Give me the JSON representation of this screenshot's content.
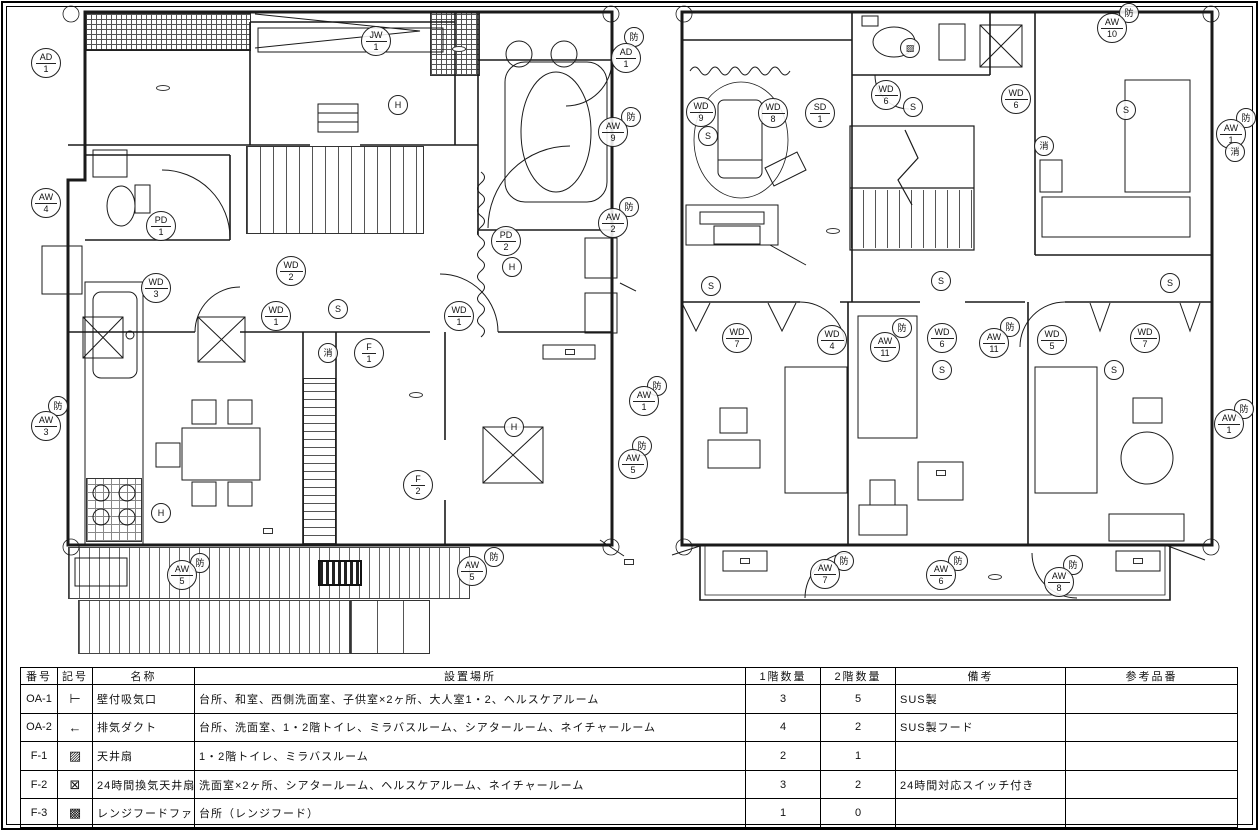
{
  "floor1": {
    "labels": [
      {
        "t": "玄関",
        "x": 103,
        "y": 47,
        "k": "r"
      },
      {
        "t": "ネイチャールーム",
        "x": 342,
        "y": 90,
        "k": "r"
      },
      {
        "t": "ギャラリー（廊下）",
        "x": 546,
        "y": 33,
        "k": "r"
      },
      {
        "t": "階段",
        "x": 325,
        "y": 165,
        "k": "r"
      },
      {
        "t": "トイレ",
        "x": 131,
        "y": 198,
        "k": "r"
      },
      {
        "t": "ミラバスルーム",
        "x": 558,
        "y": 220,
        "k": "r"
      },
      {
        "t": "廊下",
        "x": 386,
        "y": 307,
        "k": "r"
      },
      {
        "t": "台所",
        "x": 154,
        "y": 413,
        "k": "r"
      },
      {
        "t": "和室",
        "x": 520,
        "y": 399,
        "k": "r"
      },
      {
        "t": "ウッドデッキ",
        "x": 216,
        "y": 600,
        "k": "r"
      },
      {
        "t": "階段",
        "x": 378,
        "y": 631,
        "k": "r"
      },
      {
        "t": "収納",
        "x": 98,
        "y": 287,
        "k": "n"
      },
      {
        "t": "給湯器",
        "x": 44,
        "y": 297,
        "k": "n"
      },
      {
        "t": "室外機",
        "x": 52,
        "y": 240,
        "k": "n"
      },
      {
        "t": "2階用",
        "x": 62,
        "y": 257,
        "k": "n"
      },
      {
        "t": "防水",
        "x": 516,
        "y": 281,
        "k": "n"
      },
      {
        "t": "差動式",
        "x": 191,
        "y": 518,
        "k": "n"
      },
      {
        "t": "給湯器（大）",
        "x": 634,
        "y": 150,
        "k": "n"
      },
      {
        "t": "ファイアダンパー",
        "x": 650,
        "y": 180,
        "k": "n"
      },
      {
        "t": "室外機",
        "x": 646,
        "y": 294,
        "k": "n"
      },
      {
        "t": "2階用",
        "x": 602,
        "y": 260,
        "k": "n"
      },
      {
        "t": "和室用",
        "x": 602,
        "y": 315,
        "k": "n"
      },
      {
        "t": "濡れ縁",
        "x": 433,
        "y": 584,
        "k": "n"
      },
      {
        "t": "室外機",
        "x": 100,
        "y": 552,
        "k": "n"
      },
      {
        "t": "台所用",
        "x": 101,
        "y": 573,
        "k": "n"
      },
      {
        "t": "室内機",
        "x": 268,
        "y": 531,
        "k": "bx"
      },
      {
        "t": "室内機",
        "x": 570,
        "y": 352,
        "k": "bx"
      },
      {
        "t": "室内機",
        "x": 629,
        "y": 562,
        "k": "bx"
      },
      {
        "t": "1FL±0",
        "x": 163,
        "y": 88,
        "k": "lv"
      },
      {
        "t": "1FL±0",
        "x": 416,
        "y": 395,
        "k": "lv"
      },
      {
        "t": "1FL±0",
        "x": 459,
        "y": 49,
        "k": "lv"
      },
      {
        "t": "IN ▶",
        "x": 56,
        "y": 39,
        "k": "in"
      },
      {
        "t": "◀ IN",
        "x": 650,
        "y": 43,
        "k": "in"
      },
      {
        "t": "←",
        "x": 36,
        "y": 153,
        "k": "ar"
      },
      {
        "t": "←",
        "x": 57,
        "y": 265,
        "k": "ar"
      },
      {
        "t": "←",
        "x": 32,
        "y": 510,
        "k": "ar"
      },
      {
        "t": "→",
        "x": 625,
        "y": 161,
        "k": "ar"
      },
      {
        "t": "→",
        "x": 620,
        "y": 63,
        "k": "ar"
      },
      {
        "t": "⊠",
        "x": 120,
        "y": 266,
        "k": "fan"
      },
      {
        "t": "⊠",
        "x": 337,
        "y": 74,
        "k": "fan"
      },
      {
        "t": "⊠",
        "x": 544,
        "y": 266,
        "k": "fan"
      }
    ],
    "markers": [
      {
        "a": "AD",
        "b": "1",
        "x": 46,
        "y": 63
      },
      {
        "a": "JW",
        "b": "1",
        "x": 376,
        "y": 41
      },
      {
        "a": "H",
        "x": 398,
        "y": 105
      },
      {
        "a": "AW",
        "b": "4",
        "x": 46,
        "y": 203
      },
      {
        "a": "PD",
        "b": "1",
        "x": 161,
        "y": 226
      },
      {
        "a": "WD",
        "b": "3",
        "x": 156,
        "y": 288
      },
      {
        "a": "WD",
        "b": "2",
        "x": 291,
        "y": 271
      },
      {
        "a": "PD",
        "b": "2",
        "x": 506,
        "y": 241
      },
      {
        "a": "H",
        "x": 512,
        "y": 267
      },
      {
        "a": "防",
        "x": 631,
        "y": 117
      },
      {
        "a": "AW",
        "b": "9",
        "x": 613,
        "y": 132
      },
      {
        "a": "防",
        "x": 634,
        "y": 37
      },
      {
        "a": "AD",
        "b": "1",
        "x": 626,
        "y": 58
      },
      {
        "a": "防",
        "x": 629,
        "y": 207
      },
      {
        "a": "AW",
        "b": "2",
        "x": 613,
        "y": 223
      },
      {
        "a": "WD",
        "b": "1",
        "x": 276,
        "y": 316
      },
      {
        "a": "S",
        "x": 338,
        "y": 309
      },
      {
        "a": "消",
        "x": 328,
        "y": 353
      },
      {
        "a": "F",
        "b": "1",
        "x": 369,
        "y": 353
      },
      {
        "a": "WD",
        "b": "1",
        "x": 459,
        "y": 316
      },
      {
        "a": "防",
        "x": 58,
        "y": 406
      },
      {
        "a": "AW",
        "b": "3",
        "x": 46,
        "y": 426
      },
      {
        "a": "H",
        "x": 161,
        "y": 513
      },
      {
        "a": "F",
        "b": "2",
        "x": 418,
        "y": 485
      },
      {
        "a": "H",
        "x": 514,
        "y": 427
      },
      {
        "a": "防",
        "x": 657,
        "y": 386
      },
      {
        "a": "AW",
        "b": "1",
        "x": 644,
        "y": 401
      },
      {
        "a": "防",
        "x": 642,
        "y": 446
      },
      {
        "a": "AW",
        "b": "5",
        "x": 633,
        "y": 464
      },
      {
        "a": "防",
        "x": 200,
        "y": 563
      },
      {
        "a": "AW",
        "b": "5",
        "x": 182,
        "y": 575
      },
      {
        "a": "防",
        "x": 494,
        "y": 557
      },
      {
        "a": "AW",
        "b": "5",
        "x": 472,
        "y": 571
      }
    ]
  },
  "floor2": {
    "labels": [
      {
        "t": "シアタールーム",
        "x": 748,
        "y": 92,
        "k": "r"
      },
      {
        "t": "トイレ",
        "x": 875,
        "y": 46,
        "k": "r"
      },
      {
        "t": "階段",
        "x": 931,
        "y": 163,
        "k": "r"
      },
      {
        "t": "ヘルスケアルーム",
        "x": 1120,
        "y": 90,
        "k": "r"
      },
      {
        "t": "廊下",
        "x": 1013,
        "y": 283,
        "k": "r"
      },
      {
        "t": "大人室",
        "x": 739,
        "y": 371,
        "k": "r"
      },
      {
        "t": "子供室",
        "x": 943,
        "y": 386,
        "k": "r"
      },
      {
        "t": "大人室2",
        "x": 1138,
        "y": 372,
        "k": "r"
      },
      {
        "t": "ベランダ",
        "x": 888,
        "y": 589,
        "k": "r"
      },
      {
        "t": "パイプファン",
        "x": 716,
        "y": 41,
        "k": "n"
      },
      {
        "t": "（天窓）",
        "x": 888,
        "y": 365,
        "k": "n"
      },
      {
        "t": "（天窓）",
        "x": 997,
        "y": 365,
        "k": "n"
      },
      {
        "t": "室内機",
        "x": 831,
        "y": 269,
        "k": "n"
      },
      {
        "t": "室内機",
        "x": 668,
        "y": 558,
        "k": "n"
      },
      {
        "t": "室内機",
        "x": 1213,
        "y": 564,
        "k": "n"
      },
      {
        "t": "室内機",
        "x": 1225,
        "y": 246,
        "k": "n"
      },
      {
        "t": "室外機",
        "x": 745,
        "y": 561,
        "k": "bx"
      },
      {
        "t": "室外機",
        "x": 1138,
        "y": 561,
        "k": "bx"
      },
      {
        "t": "室内機",
        "x": 941,
        "y": 473,
        "k": "bx"
      },
      {
        "t": "2FL±0",
        "x": 833,
        "y": 231,
        "k": "lv"
      },
      {
        "t": "2FL±0",
        "x": 995,
        "y": 577,
        "k": "lv"
      },
      {
        "t": "→",
        "x": 1224,
        "y": 51,
        "k": "ar"
      },
      {
        "t": "→",
        "x": 1224,
        "y": 65,
        "k": "ar"
      },
      {
        "t": "↑",
        "x": 824,
        "y": 299,
        "k": "ar"
      },
      {
        "t": "↑",
        "x": 1059,
        "y": 299,
        "k": "ar"
      },
      {
        "t": "⊠",
        "x": 1114,
        "y": 73,
        "k": "fan"
      }
    ],
    "markers": [
      {
        "a": "WD",
        "b": "9",
        "x": 701,
        "y": 112
      },
      {
        "a": "S",
        "x": 708,
        "y": 136
      },
      {
        "a": "WD",
        "b": "8",
        "x": 773,
        "y": 113
      },
      {
        "a": "SD",
        "b": "1",
        "x": 820,
        "y": 113
      },
      {
        "a": "▨",
        "x": 910,
        "y": 48
      },
      {
        "a": "WD",
        "b": "6",
        "x": 886,
        "y": 95
      },
      {
        "a": "S",
        "x": 913,
        "y": 107
      },
      {
        "a": "WD",
        "b": "6",
        "x": 1016,
        "y": 99
      },
      {
        "a": "S",
        "x": 1126,
        "y": 110
      },
      {
        "a": "防",
        "x": 1129,
        "y": 13
      },
      {
        "a": "AW",
        "b": "10",
        "x": 1112,
        "y": 28
      },
      {
        "a": "消",
        "x": 1044,
        "y": 146
      },
      {
        "a": "防",
        "x": 1246,
        "y": 118
      },
      {
        "a": "AW",
        "b": "1",
        "x": 1231,
        "y": 134
      },
      {
        "a": "消",
        "x": 1235,
        "y": 152
      },
      {
        "a": "S",
        "x": 711,
        "y": 286
      },
      {
        "a": "S",
        "x": 941,
        "y": 281
      },
      {
        "a": "S",
        "x": 1170,
        "y": 283
      },
      {
        "a": "WD",
        "b": "7",
        "x": 737,
        "y": 338
      },
      {
        "a": "WD",
        "b": "4",
        "x": 832,
        "y": 340
      },
      {
        "a": "防",
        "x": 902,
        "y": 328
      },
      {
        "a": "AW",
        "b": "11",
        "x": 885,
        "y": 347
      },
      {
        "a": "WD",
        "b": "6",
        "x": 942,
        "y": 338
      },
      {
        "a": "S",
        "x": 942,
        "y": 370
      },
      {
        "a": "防",
        "x": 1010,
        "y": 327
      },
      {
        "a": "AW",
        "b": "11",
        "x": 994,
        "y": 343
      },
      {
        "a": "WD",
        "b": "5",
        "x": 1052,
        "y": 340
      },
      {
        "a": "WD",
        "b": "7",
        "x": 1145,
        "y": 338
      },
      {
        "a": "S",
        "x": 1114,
        "y": 370
      },
      {
        "a": "防",
        "x": 1244,
        "y": 409
      },
      {
        "a": "AW",
        "b": "1",
        "x": 1229,
        "y": 424
      },
      {
        "a": "防",
        "x": 844,
        "y": 561
      },
      {
        "a": "AW",
        "b": "7",
        "x": 825,
        "y": 574
      },
      {
        "a": "防",
        "x": 958,
        "y": 561
      },
      {
        "a": "AW",
        "b": "6",
        "x": 941,
        "y": 575
      },
      {
        "a": "防",
        "x": 1073,
        "y": 565
      },
      {
        "a": "AW",
        "b": "8",
        "x": 1059,
        "y": 582
      }
    ]
  },
  "schedule": {
    "headers": [
      "番号",
      "記号",
      "名称",
      "設置場所",
      "1階数量",
      "2階数量",
      "備考",
      "参考品番"
    ],
    "rows": [
      {
        "no": "OA-1",
        "sym": "⊢",
        "sym_name": "wall-intake-icon",
        "name": "壁付吸気口",
        "place": "台所、和室、西側洗面室、子供室×2ヶ所、大人室1・2、ヘルスケアルーム",
        "q1": "3",
        "q2": "5",
        "note": "SUS製",
        "ref": ""
      },
      {
        "no": "OA-2",
        "sym": "←",
        "sym_name": "exhaust-duct-icon",
        "name": "排気ダクト",
        "place": "台所、洗面室、1・2階トイレ、ミラバスルーム、シアタールーム、ネイチャールーム",
        "q1": "4",
        "q2": "2",
        "note": "SUS製フード",
        "ref": ""
      },
      {
        "no": "F-1",
        "sym": "▨",
        "sym_name": "ceiling-fan-icon",
        "name": "天井扇",
        "place": "1・2階トイレ、ミラバスルーム",
        "q1": "2",
        "q2": "1",
        "note": "",
        "ref": ""
      },
      {
        "no": "F-2",
        "sym": "⊠",
        "sym_name": "24h-ventilation-fan-icon",
        "name": "24時間換気天井扇",
        "place": "洗面室×2ヶ所、シアタールーム、ヘルスケアルーム、ネイチャールーム",
        "q1": "3",
        "q2": "2",
        "note": "24時間対応スイッチ付き",
        "ref": ""
      },
      {
        "no": "F-3",
        "sym": "▩",
        "sym_name": "range-hood-fan-icon",
        "name": "レンジフードファン",
        "place": "台所（レンジフード）",
        "q1": "1",
        "q2": "0",
        "note": "",
        "ref": ""
      }
    ]
  }
}
